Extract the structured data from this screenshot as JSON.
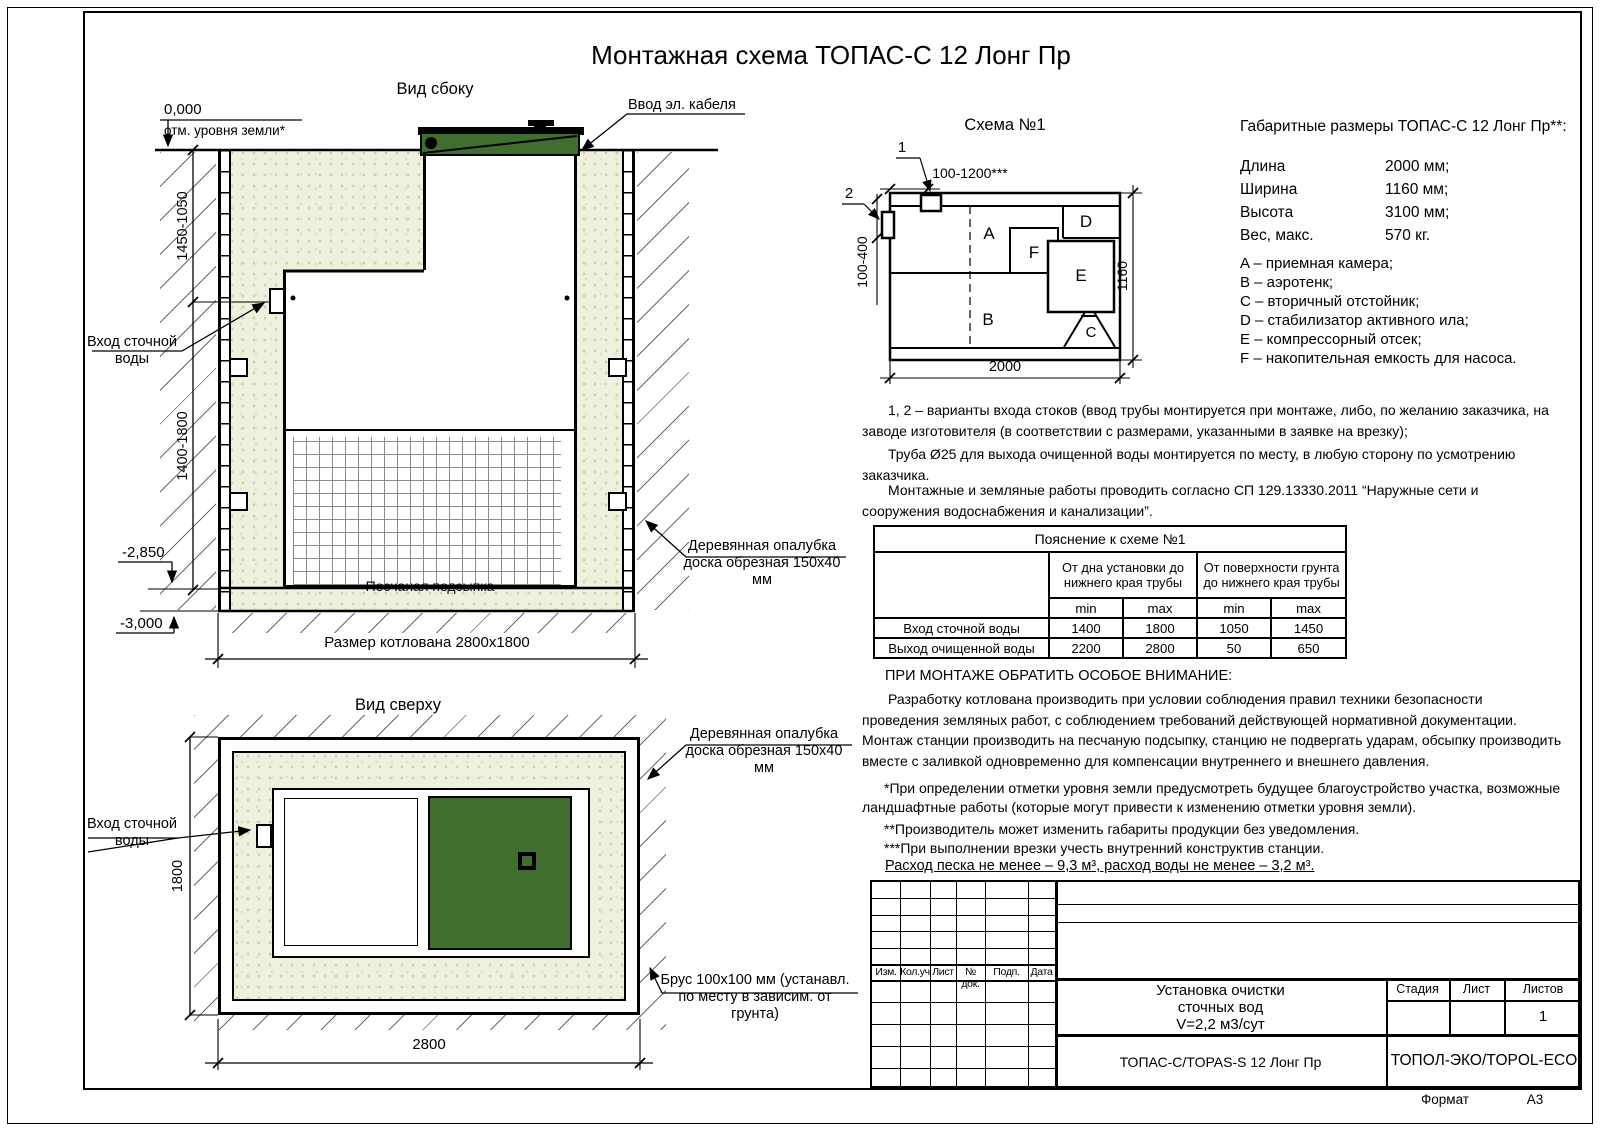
{
  "title": "Монтажная схема ТОПАС-С 12 Лонг Пр",
  "colors": {
    "lid_green": "#3F6E2F",
    "sand": "#EFF0DE"
  },
  "side_view": {
    "label": "Вид сбоку",
    "zero_mark": "0,000",
    "zero_label": "отм. уровня земли*",
    "cable_label": "Ввод эл. кабеля",
    "dim_upper": "1450-1050",
    "dim_lower": "1400-1800",
    "level_sand": "-2,850",
    "level_bottom": "-3,000",
    "inlet_label": "Вход сточной воды",
    "sand_label": "Песчаная подсыпка",
    "pit_size_label": "Размер котлована 2800х1800",
    "formwork_label": "Деревянная опалубка доска обрезная 150х40 мм"
  },
  "top_view": {
    "label": "Вид сверху",
    "inlet_label": "Вход сточной воды",
    "dim_width": "1800",
    "dim_length": "2800",
    "formwork_label": "Деревянная опалубка доска обрезная 150х40 мм",
    "beam_label": "Брус 100х100 мм (устанавл. по месту в зависим. от грунта)"
  },
  "schema": {
    "label": "Схема №1",
    "marker_1": "1",
    "marker_2": "2",
    "dim_top": "100-1200***",
    "dim_left": "100-400",
    "dim_right": "1160",
    "dim_bottom": "2000",
    "compartments": {
      "a": "A",
      "b": "B",
      "c": "C",
      "d": "D",
      "e": "E",
      "f": "F"
    }
  },
  "specs": {
    "title": "Габаритные размеры ТОПАС-С 12 Лонг Пр**:",
    "rows": [
      {
        "name": "Длина",
        "value": "2000 мм;"
      },
      {
        "name": "Ширина",
        "value": "1160 мм;"
      },
      {
        "name": "Высота",
        "value": "3100 мм;"
      },
      {
        "name": "Вес, макс.",
        "value": "570 кг."
      }
    ],
    "legend": [
      "A – приемная камера;",
      "B – аэротенк;",
      "C – вторичный отстойник;",
      "D – стабилизатор активного ила;",
      "E – компрессорный отсек;",
      "F – накопительная емкость для насоса."
    ]
  },
  "notes": {
    "note_1": "1, 2 – варианты входа  стоков (ввод трубы монтируется при монтаже, либо, по желанию заказчика, на заводе изготовителя (в соответствии с размерами, указанными в заявке на врезку);",
    "note_2": "Труба Ø25 для выхода очищенной воды монтируется по месту, в любую сторону по усмотрению заказчика.",
    "note_3": "Монтажные и земляные работы проводить согласно СП 129.13330.2011 “Наружные сети и сооружения водоснабжения и канализации”."
  },
  "table": {
    "title": "Пояснение к схеме №1",
    "col_group_1": "От дна установки до нижнего края трубы",
    "col_group_2": "От поверхности грунта до нижнего края трубы",
    "sub_headers": [
      "min",
      "max",
      "min",
      "max"
    ],
    "rows": [
      {
        "name": "Вход сточной воды",
        "v1": "1400",
        "v2": "1800",
        "v3": "1050",
        "v4": "1450"
      },
      {
        "name": "Выход очищенной воды",
        "v1": "2200",
        "v2": "2800",
        "v3": "50",
        "v4": "650"
      }
    ]
  },
  "warning": {
    "heading": "ПРИ МОНТАЖЕ ОБРАТИТЬ ОСОБОЕ ВНИМАНИЕ:",
    "body": "Разработку котлована производить при условии соблюдения правил техники безопасности проведения земляных работ, с соблюдением требований действующей нормативной документации. Монтаж станции производить на песчаную подсыпку, станцию не подвергать ударам, обсыпку производить вместе с заливкой одновременно для компенсации внутреннего и внешнего давления.",
    "footnote_1": "*При определении отметки уровня земли предусмотреть будущее благоустройство участка, возможные ландшафтные работы (которые могут привести к изменению отметки уровня земли).",
    "footnote_2": "**Производитель может изменить габариты продукции без уведомления.",
    "footnote_3": "***При выполнении врезки учесть внутренний конструктив станции.",
    "consumption": "Расход песка не менее – 9,3 м³, расход воды не менее – 3,2 м³."
  },
  "stamp": {
    "rev_columns": [
      "Изм.",
      "Кол.уч",
      "Лист",
      "№ док.",
      "Подп.",
      "Дата"
    ],
    "product_line_1": "Установка очистки",
    "product_line_2": "сточных вод",
    "product_line_3": "V=2,2 м3/сут",
    "stage_label": "Стадия",
    "sheet_label": "Лист",
    "sheets_label": "Листов",
    "sheets_value": "1",
    "model": "ТОПАС-С/TOPAS-S 12 Лонг Пр",
    "company": "ТОПОЛ-ЭКО/TOPOL-ECO",
    "format_label": "Формат",
    "format_value": "А3"
  }
}
